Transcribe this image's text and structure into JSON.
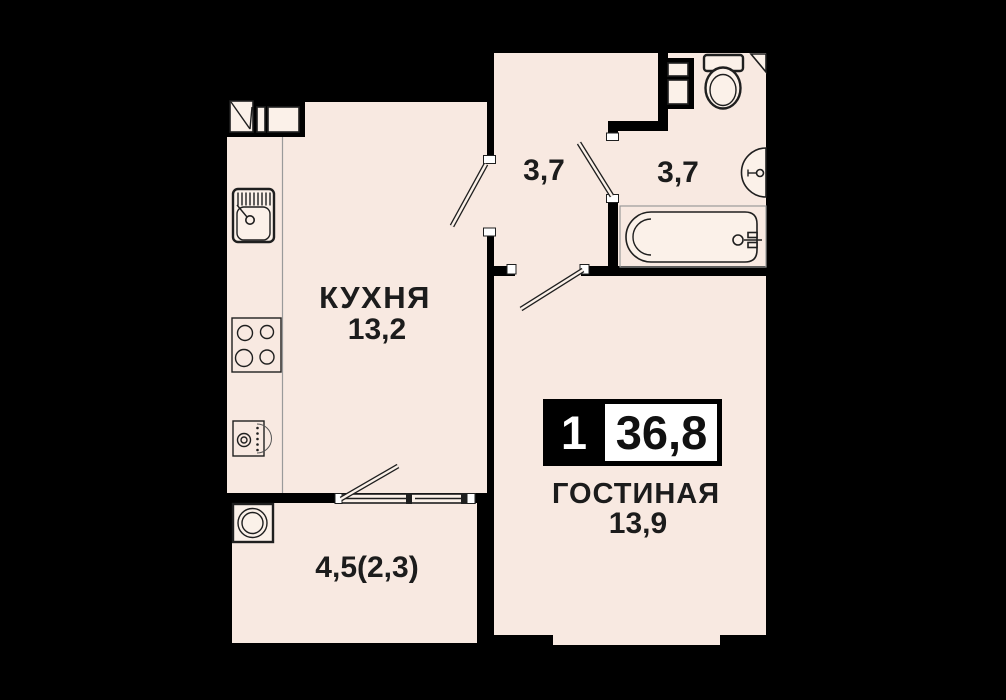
{
  "plan": {
    "type": "apartment-floor-plan",
    "badge": {
      "rooms_count": "1",
      "total_area": "36,8"
    },
    "rooms": {
      "kitchen": {
        "label": "КУХНЯ",
        "area": "13,2"
      },
      "hallway": {
        "area": "3,7"
      },
      "bathroom": {
        "area": "3,7"
      },
      "living": {
        "label": "ГОСТИНАЯ",
        "area": "13,9"
      },
      "balcony": {
        "area": "4,5(2,3)"
      }
    },
    "colors": {
      "background": "#000000",
      "floor": "#f8e9e1",
      "fixture": "#fbf1e9",
      "line": "#1f1f1f"
    }
  }
}
